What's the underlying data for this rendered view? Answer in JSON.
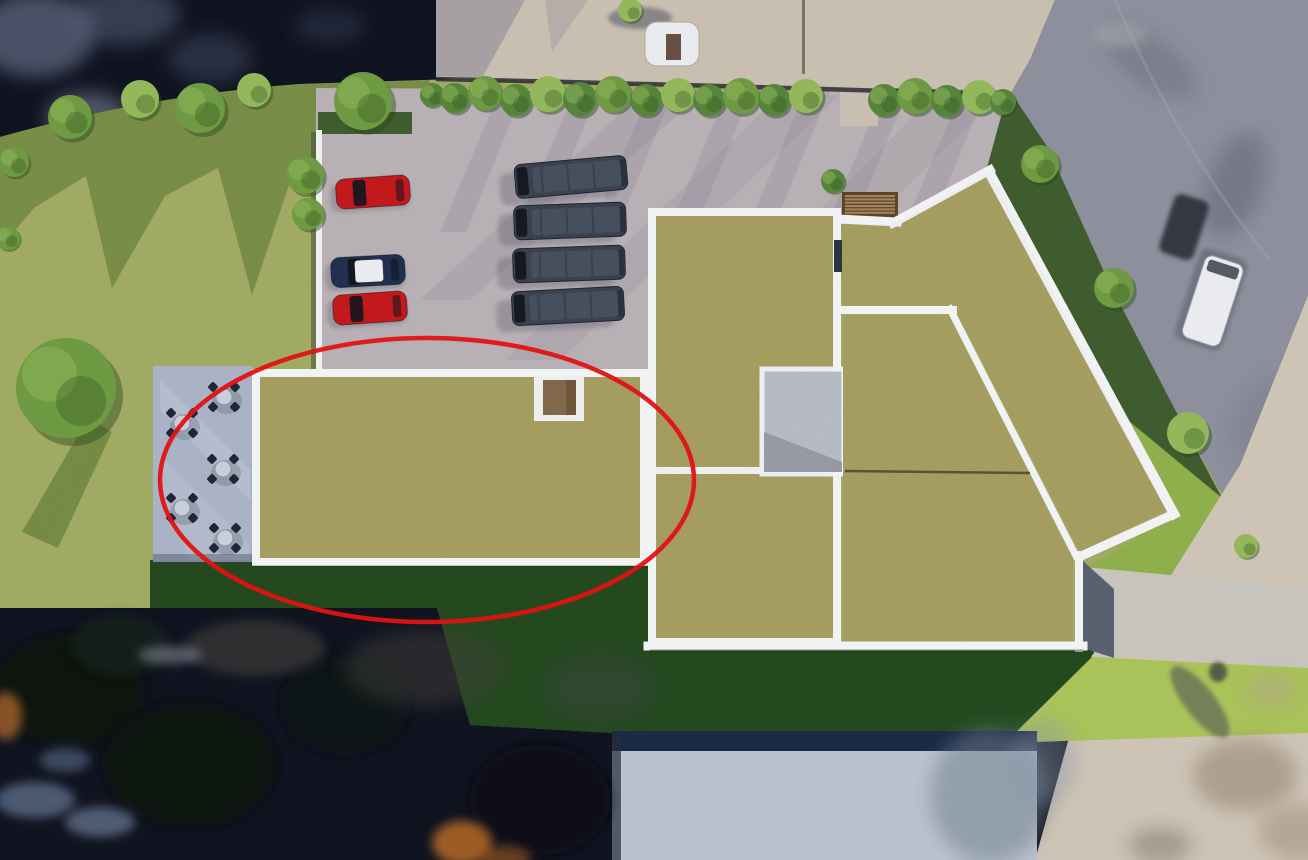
{
  "scene": {
    "kind": "aerial-architectural-site-rendering",
    "highlight": {
      "shape": "ellipse",
      "cx": 427,
      "cy": 480,
      "rx": 267,
      "ry": 142,
      "stroke_width": 4.5
    },
    "counts": {
      "parking_cars": 3,
      "parking_vans": 4,
      "patio_tables": 5,
      "green_roof_sections": 4
    }
  },
  "colors": {
    "photo_dark": "#101320",
    "road_top": "#c9bfb1",
    "road_asphalt": "#8d909c",
    "sidewalk": "#cec4b6",
    "lot": "#b7b0b4",
    "lot_shadow": "#6e6880",
    "grass": "#9fa95e",
    "grass_shadow": "#67803c",
    "grass_medium": "#8fae4c",
    "grass_dark": "#24491f",
    "grass_bright": "#a9c259",
    "strip_dark": "#3f5c2f",
    "roof": "#a39a58",
    "parapet": "#f1f2f4",
    "courtyard": "#b6bac4",
    "patio": "#a9b3c5",
    "table": "#c9cfda",
    "chair": "#1d2737",
    "tree": "#6d9a43",
    "tree_light": "#93b85c",
    "hedge": "#55853a",
    "car_red": "#c2191c",
    "car_navy": "#20304e",
    "car_white": "#e9ebee",
    "van": "#3a414f",
    "van_window": "#141923",
    "steps_wood": "#a3825c",
    "steps_base": "#5d4527",
    "hatch_brown": "#7d6140",
    "annotation_red": "#e31212",
    "white_bldg": "#b9c2ce",
    "white_bldg_band": "#1a2a47",
    "path": "#c7c4be",
    "wall_white": "#eef0f3",
    "line_dark": "#2f2f28",
    "stair_panel": "#2b3442"
  },
  "objects": {
    "trees": [
      {
        "x": 70,
        "y": 117,
        "r": 22,
        "c": "tree"
      },
      {
        "x": 140,
        "y": 99,
        "r": 19,
        "c": "tree_light"
      },
      {
        "x": 200,
        "y": 108,
        "r": 25,
        "c": "tree"
      },
      {
        "x": 254,
        "y": 90,
        "r": 17,
        "c": "tree_light"
      },
      {
        "x": 305,
        "y": 175,
        "r": 19,
        "c": "tree"
      },
      {
        "x": 308,
        "y": 214,
        "r": 16,
        "c": "tree"
      },
      {
        "x": 363,
        "y": 101,
        "r": 29,
        "c": "tree"
      },
      {
        "x": 14,
        "y": 162,
        "r": 15,
        "c": "tree"
      },
      {
        "x": 8,
        "y": 238,
        "r": 12,
        "c": "tree"
      },
      {
        "x": 66,
        "y": 388,
        "r": 50,
        "c": "tree"
      },
      {
        "x": 432,
        "y": 95,
        "r": 12,
        "c": "hedge"
      },
      {
        "x": 455,
        "y": 98,
        "r": 15,
        "c": "hedge"
      },
      {
        "x": 485,
        "y": 93,
        "r": 17,
        "c": "tree"
      },
      {
        "x": 516,
        "y": 100,
        "r": 16,
        "c": "hedge"
      },
      {
        "x": 548,
        "y": 94,
        "r": 18,
        "c": "tree_light"
      },
      {
        "x": 580,
        "y": 99,
        "r": 17,
        "c": "hedge"
      },
      {
        "x": 613,
        "y": 94,
        "r": 18,
        "c": "tree"
      },
      {
        "x": 646,
        "y": 100,
        "r": 16,
        "c": "hedge"
      },
      {
        "x": 678,
        "y": 95,
        "r": 17,
        "c": "tree_light"
      },
      {
        "x": 709,
        "y": 100,
        "r": 16,
        "c": "hedge"
      },
      {
        "x": 741,
        "y": 96,
        "r": 18,
        "c": "tree"
      },
      {
        "x": 774,
        "y": 100,
        "r": 16,
        "c": "hedge"
      },
      {
        "x": 806,
        "y": 96,
        "r": 17,
        "c": "tree_light"
      },
      {
        "x": 833,
        "y": 181,
        "r": 12,
        "c": "hedge"
      },
      {
        "x": 884,
        "y": 100,
        "r": 16,
        "c": "hedge"
      },
      {
        "x": 915,
        "y": 96,
        "r": 18,
        "c": "tree"
      },
      {
        "x": 947,
        "y": 101,
        "r": 16,
        "c": "hedge"
      },
      {
        "x": 979,
        "y": 97,
        "r": 17,
        "c": "tree_light"
      },
      {
        "x": 1003,
        "y": 102,
        "r": 13,
        "c": "hedge"
      },
      {
        "x": 1040,
        "y": 164,
        "r": 19,
        "c": "tree"
      },
      {
        "x": 1114,
        "y": 288,
        "r": 20,
        "c": "tree"
      },
      {
        "x": 1188,
        "y": 433,
        "r": 21,
        "c": "tree_light"
      },
      {
        "x": 1246,
        "y": 546,
        "r": 12,
        "c": "tree_light"
      },
      {
        "x": 630,
        "y": 10,
        "r": 12,
        "c": "tree_light"
      }
    ],
    "tables": [
      {
        "x": 224,
        "y": 397
      },
      {
        "x": 182,
        "y": 423
      },
      {
        "x": 223,
        "y": 469
      },
      {
        "x": 182,
        "y": 508
      },
      {
        "x": 225,
        "y": 538
      }
    ],
    "cars": [
      {
        "x": 373,
        "y": 192,
        "rot": -4,
        "body": "car_red"
      },
      {
        "x": 368,
        "y": 271,
        "rot": -3,
        "body": "car_navy",
        "roof": true
      },
      {
        "x": 370,
        "y": 308,
        "rot": -4,
        "body": "car_red"
      }
    ],
    "vans": [
      {
        "x": 571,
        "y": 177,
        "rot": -5
      },
      {
        "x": 570,
        "y": 221,
        "rot": -2
      },
      {
        "x": 569,
        "y": 264,
        "rot": -2
      },
      {
        "x": 568,
        "y": 306,
        "rot": -3
      }
    ],
    "streaks": [
      500,
      575,
      650,
      728,
      806,
      884,
      962
    ],
    "steps": {
      "x": 842,
      "y": 192,
      "w": 56,
      "h": 26,
      "slats": 6
    },
    "blobs": [
      {
        "l": "clouds",
        "x": 35,
        "y": 35,
        "rx": 60,
        "ry": 42,
        "c": "#67738c",
        "o": 0.65,
        "f": "b6"
      },
      {
        "l": "clouds",
        "x": 125,
        "y": 15,
        "rx": 55,
        "ry": 30,
        "c": "#5c6880",
        "o": 0.5,
        "f": "b6"
      },
      {
        "l": "clouds",
        "x": 88,
        "y": 118,
        "rx": 42,
        "ry": 26,
        "c": "#8c96ad",
        "o": 0.5,
        "f": "b6"
      },
      {
        "l": "clouds",
        "x": 210,
        "y": 58,
        "rx": 42,
        "ry": 24,
        "c": "#49546e",
        "o": 0.45,
        "f": "b6"
      },
      {
        "l": "clouds",
        "x": 330,
        "y": 26,
        "rx": 36,
        "ry": 18,
        "c": "#3b455e",
        "o": 0.4,
        "f": "b6"
      },
      {
        "l": "road",
        "x": 1150,
        "y": 62,
        "rx": 55,
        "ry": 24,
        "c": "#6a6f7c",
        "o": 0.5,
        "f": "b6",
        "rot": 35
      },
      {
        "l": "road",
        "x": 1235,
        "y": 185,
        "rx": 28,
        "ry": 55,
        "c": "#5a5f6c",
        "o": 0.45,
        "f": "b6",
        "rot": 20
      },
      {
        "l": "road",
        "x": 1120,
        "y": 35,
        "rx": 26,
        "ry": 13,
        "c": "#a9aab4",
        "o": 0.5,
        "f": "b4"
      },
      {
        "l": "road",
        "x": 1262,
        "y": 420,
        "rx": 30,
        "ry": 48,
        "c": "#767a87",
        "o": 0.4,
        "f": "b6",
        "rot": 25
      },
      {
        "l": "photo",
        "x": 70,
        "y": 690,
        "rx": 75,
        "ry": 55,
        "c": "#0b1511",
        "o": 0.9,
        "f": "b4"
      },
      {
        "l": "photo",
        "x": 190,
        "y": 765,
        "rx": 85,
        "ry": 62,
        "c": "#0a120f",
        "o": 0.85,
        "f": "b4"
      },
      {
        "l": "photo",
        "x": 345,
        "y": 705,
        "rx": 62,
        "ry": 48,
        "c": "#0c1712",
        "o": 0.9,
        "f": "b4"
      },
      {
        "l": "photo",
        "x": 120,
        "y": 645,
        "rx": 48,
        "ry": 30,
        "c": "#16231b",
        "o": 0.8,
        "f": "b4"
      },
      {
        "l": "photo",
        "x": 540,
        "y": 800,
        "rx": 70,
        "ry": 55,
        "c": "#0a0f14",
        "o": 0.8,
        "f": "b4"
      },
      {
        "l": "photo",
        "x": 255,
        "y": 648,
        "rx": 70,
        "ry": 28,
        "c": "#4a473f",
        "o": 0.55,
        "f": "b4"
      },
      {
        "l": "photo",
        "x": 425,
        "y": 668,
        "rx": 80,
        "ry": 38,
        "c": "#403f39",
        "o": 0.5,
        "f": "b6"
      },
      {
        "l": "photo",
        "x": 600,
        "y": 688,
        "rx": 55,
        "ry": 32,
        "c": "#3c4442",
        "o": 0.45,
        "f": "b6"
      },
      {
        "l": "photo",
        "x": 35,
        "y": 800,
        "rx": 40,
        "ry": 18,
        "c": "#7d95b8",
        "o": 0.55,
        "f": "b4"
      },
      {
        "l": "photo",
        "x": 100,
        "y": 822,
        "rx": 35,
        "ry": 15,
        "c": "#8fa6c4",
        "o": 0.5,
        "f": "b4"
      },
      {
        "l": "photo",
        "x": 65,
        "y": 760,
        "rx": 25,
        "ry": 12,
        "c": "#6a7f9e",
        "o": 0.5,
        "f": "b4"
      },
      {
        "l": "photo",
        "x": 462,
        "y": 843,
        "rx": 30,
        "ry": 22,
        "c": "#c06f28",
        "o": 0.8,
        "f": "b4"
      },
      {
        "l": "photo",
        "x": 6,
        "y": 716,
        "rx": 16,
        "ry": 24,
        "c": "#b96f2e",
        "o": 0.7,
        "f": "b4"
      },
      {
        "l": "photo",
        "x": 505,
        "y": 858,
        "rx": 26,
        "ry": 12,
        "c": "#a35d20",
        "o": 0.6,
        "f": "b4"
      },
      {
        "l": "photo",
        "x": 170,
        "y": 655,
        "rx": 32,
        "ry": 9,
        "c": "#959ca6",
        "o": 0.5,
        "f": "b4"
      },
      {
        "l": "photo",
        "x": 990,
        "y": 795,
        "rx": 60,
        "ry": 68,
        "c": "#6e7b8c",
        "o": 0.5,
        "f": "b6"
      },
      {
        "l": "photo",
        "x": 1045,
        "y": 762,
        "rx": 32,
        "ry": 42,
        "c": "#8b97a8",
        "o": 0.4,
        "f": "b6"
      },
      {
        "l": "path",
        "x": 1200,
        "y": 702,
        "rx": 15,
        "ry": 44,
        "c": "#4a4e57",
        "o": 0.55,
        "f": "b2",
        "rot": -38
      },
      {
        "l": "path",
        "x": 1218,
        "y": 672,
        "rx": 9,
        "ry": 10,
        "c": "#31343c",
        "o": 0.7,
        "f": "b2"
      },
      {
        "l": "path",
        "x": 1245,
        "y": 775,
        "rx": 52,
        "ry": 36,
        "c": "#8a7a66",
        "o": 0.5,
        "f": "b6"
      },
      {
        "l": "path",
        "x": 1300,
        "y": 832,
        "rx": 42,
        "ry": 28,
        "c": "#97846f",
        "o": 0.45,
        "f": "b6"
      },
      {
        "l": "path",
        "x": 1160,
        "y": 845,
        "rx": 32,
        "ry": 18,
        "c": "#6b5f52",
        "o": 0.4,
        "f": "b6"
      },
      {
        "l": "path",
        "x": 1272,
        "y": 690,
        "rx": 26,
        "ry": 15,
        "c": "#b3a18d",
        "o": 0.5,
        "f": "b6"
      }
    ]
  }
}
